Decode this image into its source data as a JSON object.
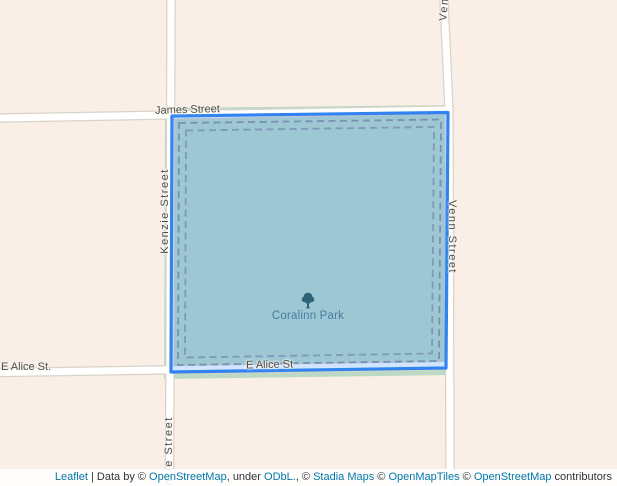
{
  "map": {
    "streets": {
      "james": "James Street",
      "kenzie_upper": "Kenzie Street",
      "kenzie_lower": "Kenzie Street",
      "venn_top": "Venn Street",
      "venn_right": "Venn Street",
      "e_alice_left": "E Alice St.",
      "e_alice_inner": "E Alice St"
    },
    "park": {
      "name": "Coralinn Park",
      "icon": "tree-icon"
    },
    "colors": {
      "background": "#f9efe7",
      "park_fill_base": "#bcd9c6",
      "road": "#ffffff",
      "road_casing": "#d9d3c9",
      "boundary_dash": "#8d949c",
      "street_label": "#4c4c4c",
      "park_label": "#4b7ba0",
      "overlay_stroke": "#3184f0",
      "overlay_fill": "rgba(51,136,255,0.22)",
      "attribution_link": "#0078a8"
    }
  },
  "attribution": {
    "parts": [
      {
        "text": "Leaflet",
        "link": true
      },
      {
        "text": " | Data by © ",
        "link": false
      },
      {
        "text": "OpenStreetMap",
        "link": true
      },
      {
        "text": ", under ",
        "link": false
      },
      {
        "text": "ODbL.",
        "link": true
      },
      {
        "text": ", © ",
        "link": false
      },
      {
        "text": "Stadia Maps",
        "link": true
      },
      {
        "text": " © ",
        "link": false
      },
      {
        "text": "OpenMapTiles",
        "link": true
      },
      {
        "text": " © ",
        "link": false
      },
      {
        "text": "OpenStreetMap",
        "link": true
      },
      {
        "text": " contributors",
        "link": false
      }
    ]
  }
}
